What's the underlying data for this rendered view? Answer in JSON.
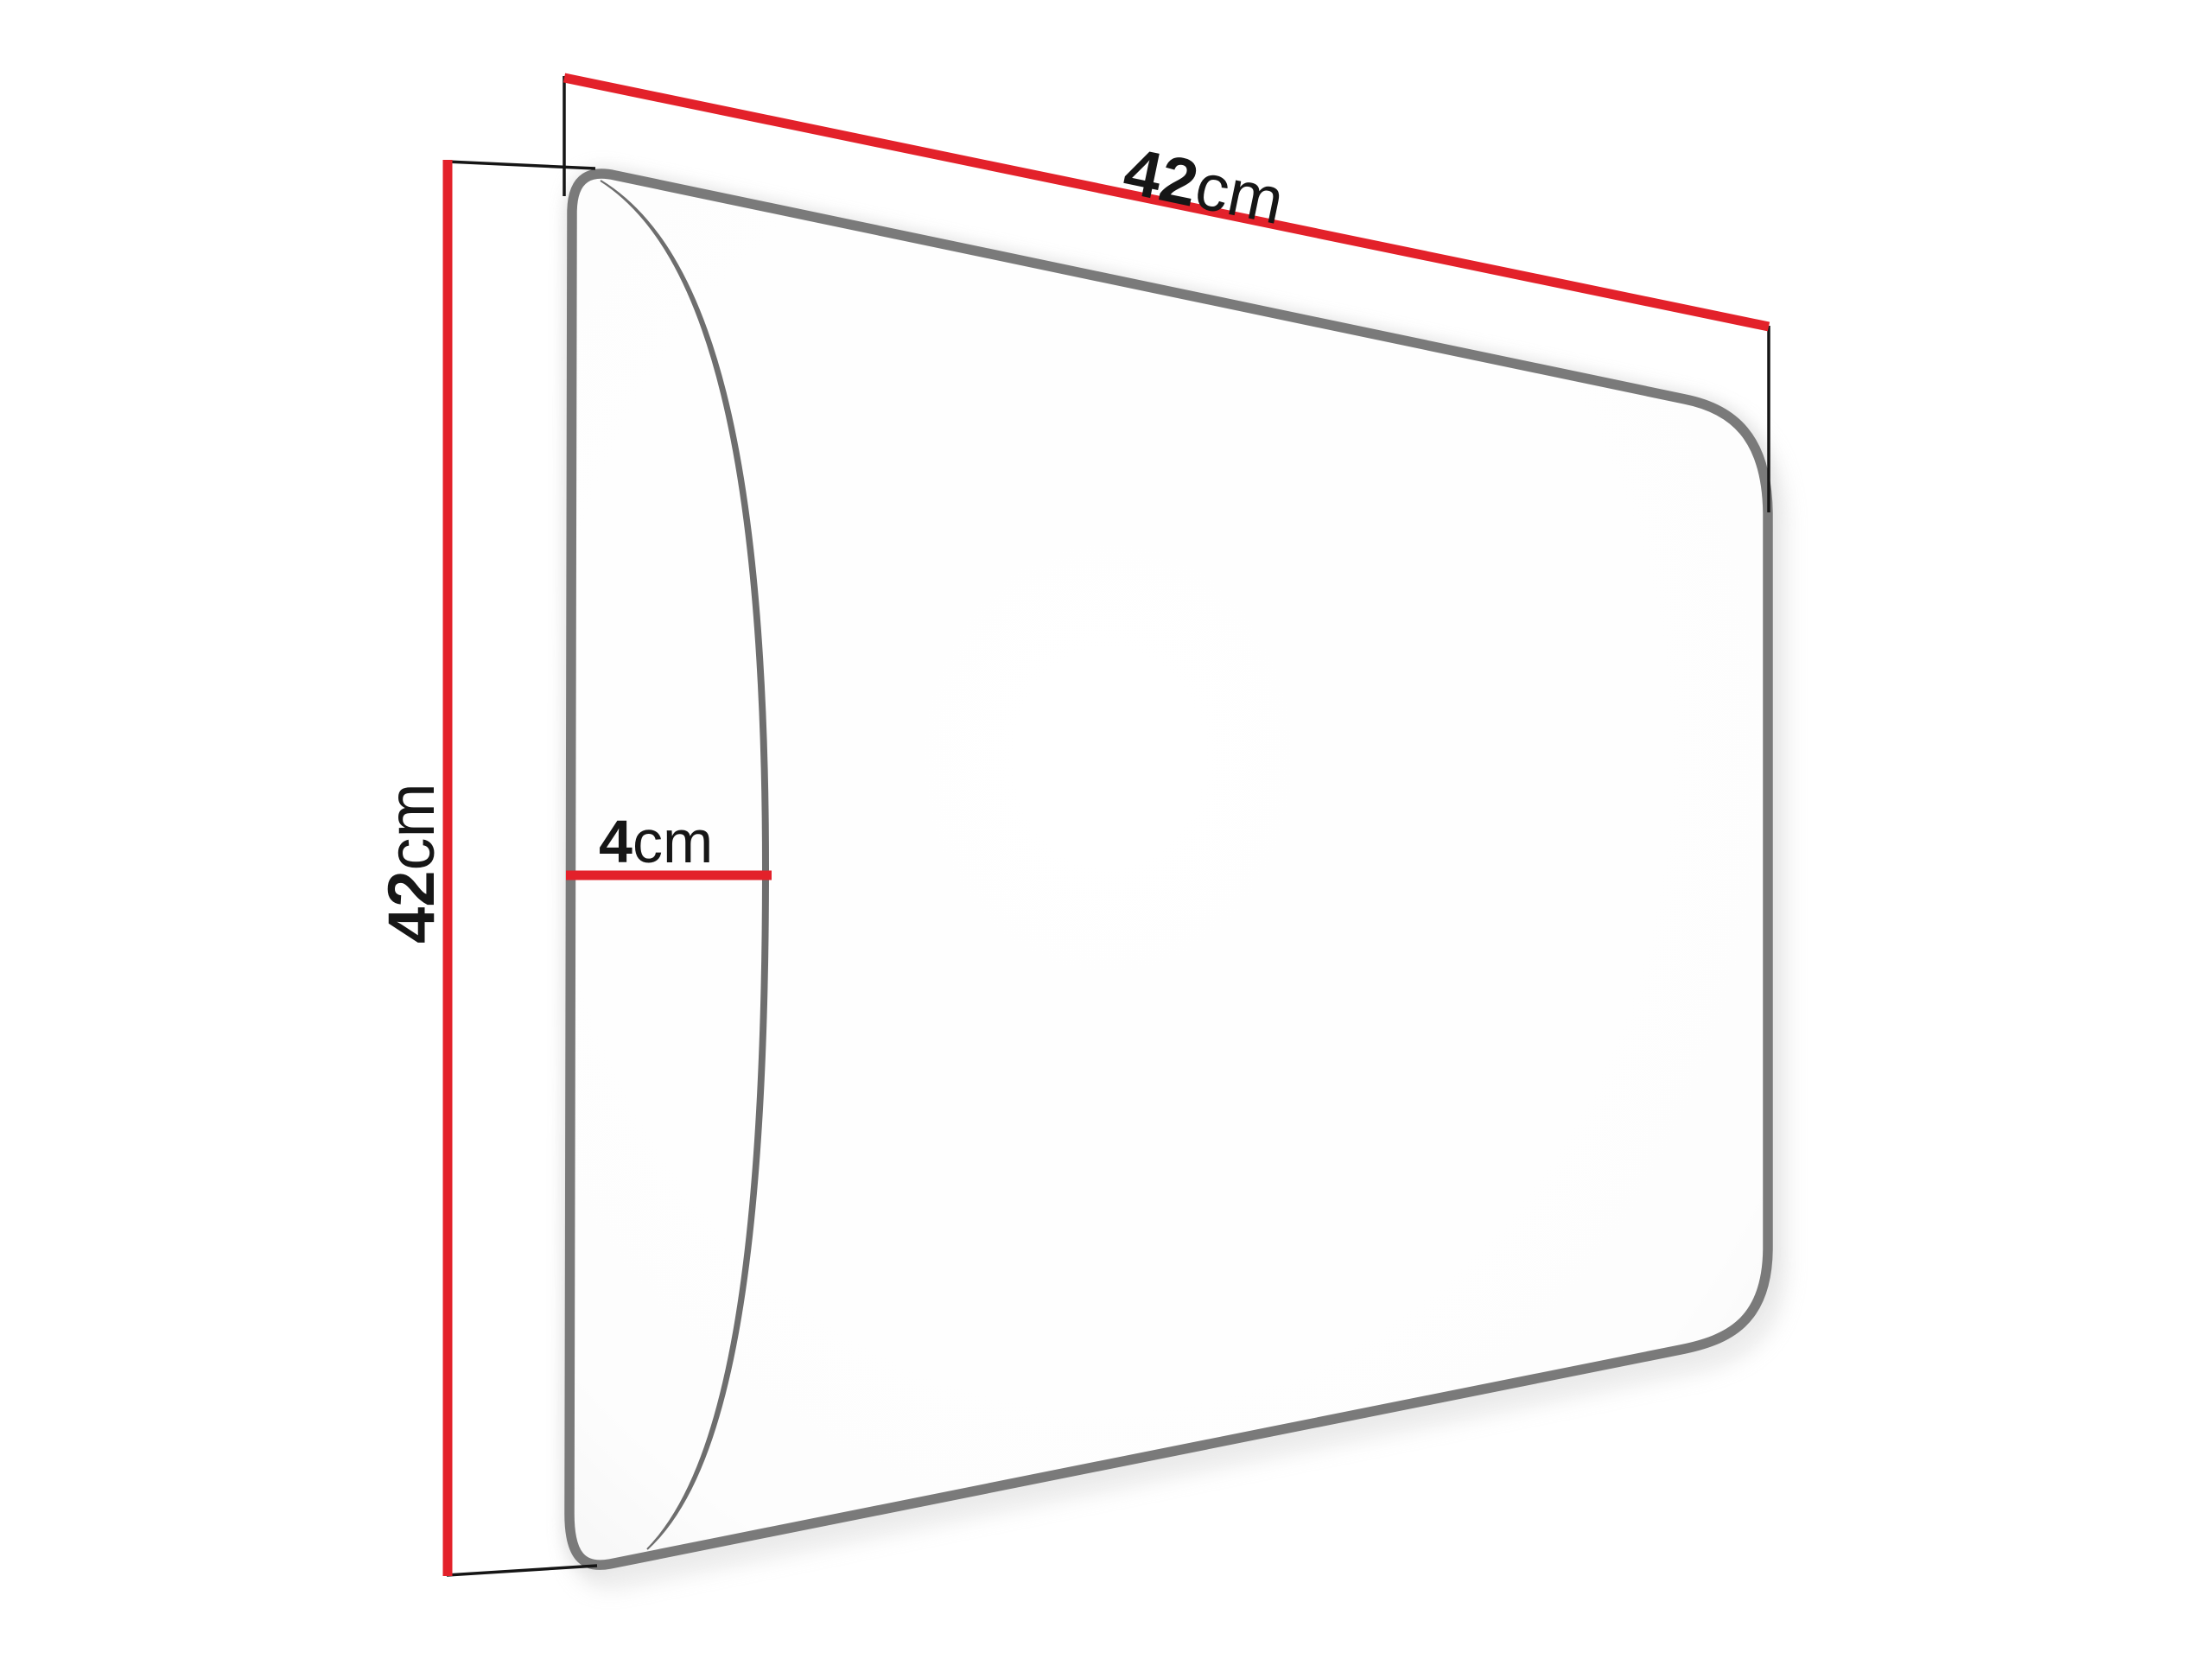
{
  "diagram": {
    "dimensions": {
      "width": {
        "value": "42",
        "unit": "cm"
      },
      "height": {
        "value": "42",
        "unit": "cm"
      },
      "depth": {
        "value": "4",
        "unit": "cm"
      }
    },
    "colors": {
      "dimension_line": "#e3212a",
      "panel_outline": "#7a7a7a",
      "cushion_line": "#6e6e6e",
      "extension_line": "#151515",
      "label_text": "#161616",
      "background": "#ffffff"
    }
  }
}
